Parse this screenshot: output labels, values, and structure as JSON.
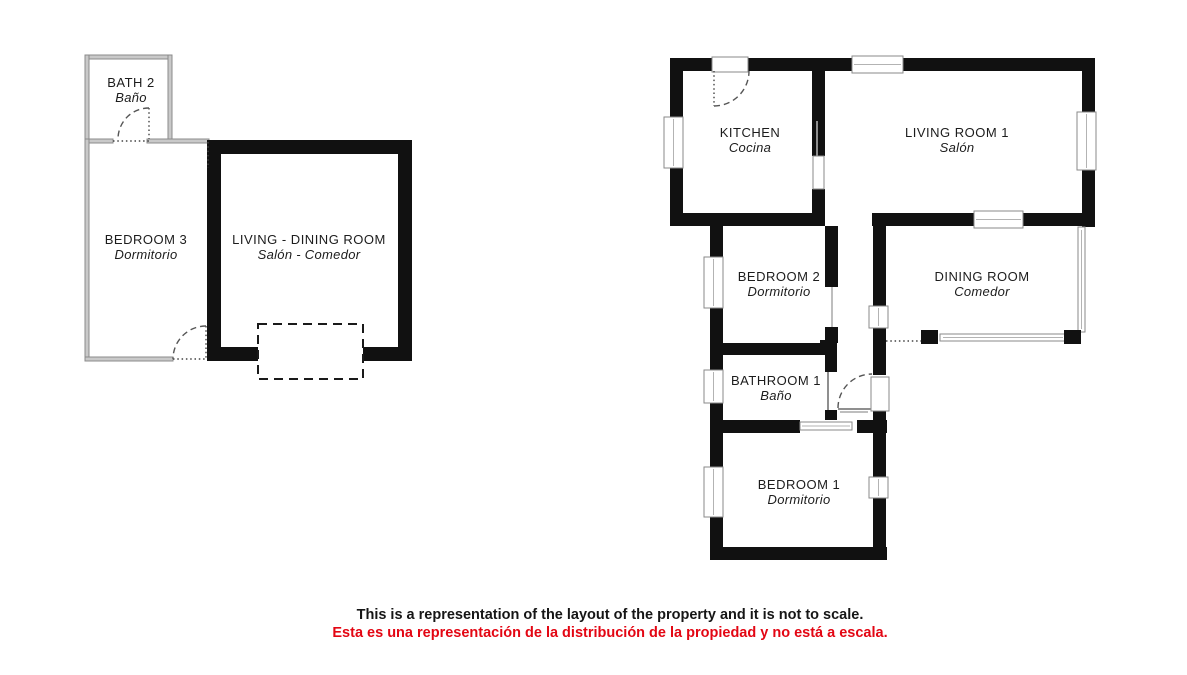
{
  "plans": {
    "left": {
      "rooms": {
        "bath2": {
          "en": "BATH 2",
          "es": "Baño"
        },
        "bedroom3": {
          "en": "BEDROOM 3",
          "es": "Dormitorio"
        },
        "living_dining": {
          "en": "LIVING - DINING ROOM",
          "es": "Salón - Comedor"
        }
      }
    },
    "right": {
      "rooms": {
        "kitchen": {
          "en": "KITCHEN",
          "es": "Cocina"
        },
        "living1": {
          "en": "LIVING ROOM 1",
          "es": "Salón"
        },
        "bedroom2": {
          "en": "BEDROOM 2",
          "es": "Dormitorio"
        },
        "dining": {
          "en": "DINING ROOM",
          "es": "Comedor"
        },
        "bathroom1": {
          "en": "BATHROOM 1",
          "es": "Baño"
        },
        "bedroom1": {
          "en": "BEDROOM 1",
          "es": "Dormitorio"
        }
      }
    }
  },
  "disclaimer": {
    "en": "This is a representation of the layout of the property and it is not to scale.",
    "es": "Esta es una representación de la distribución de la propiedad y no está a escala."
  },
  "colors": {
    "wall": "#111111",
    "thin_wall": "#c9c9c9",
    "disclaimer_en": "#161616",
    "disclaimer_es": "#e30613"
  }
}
